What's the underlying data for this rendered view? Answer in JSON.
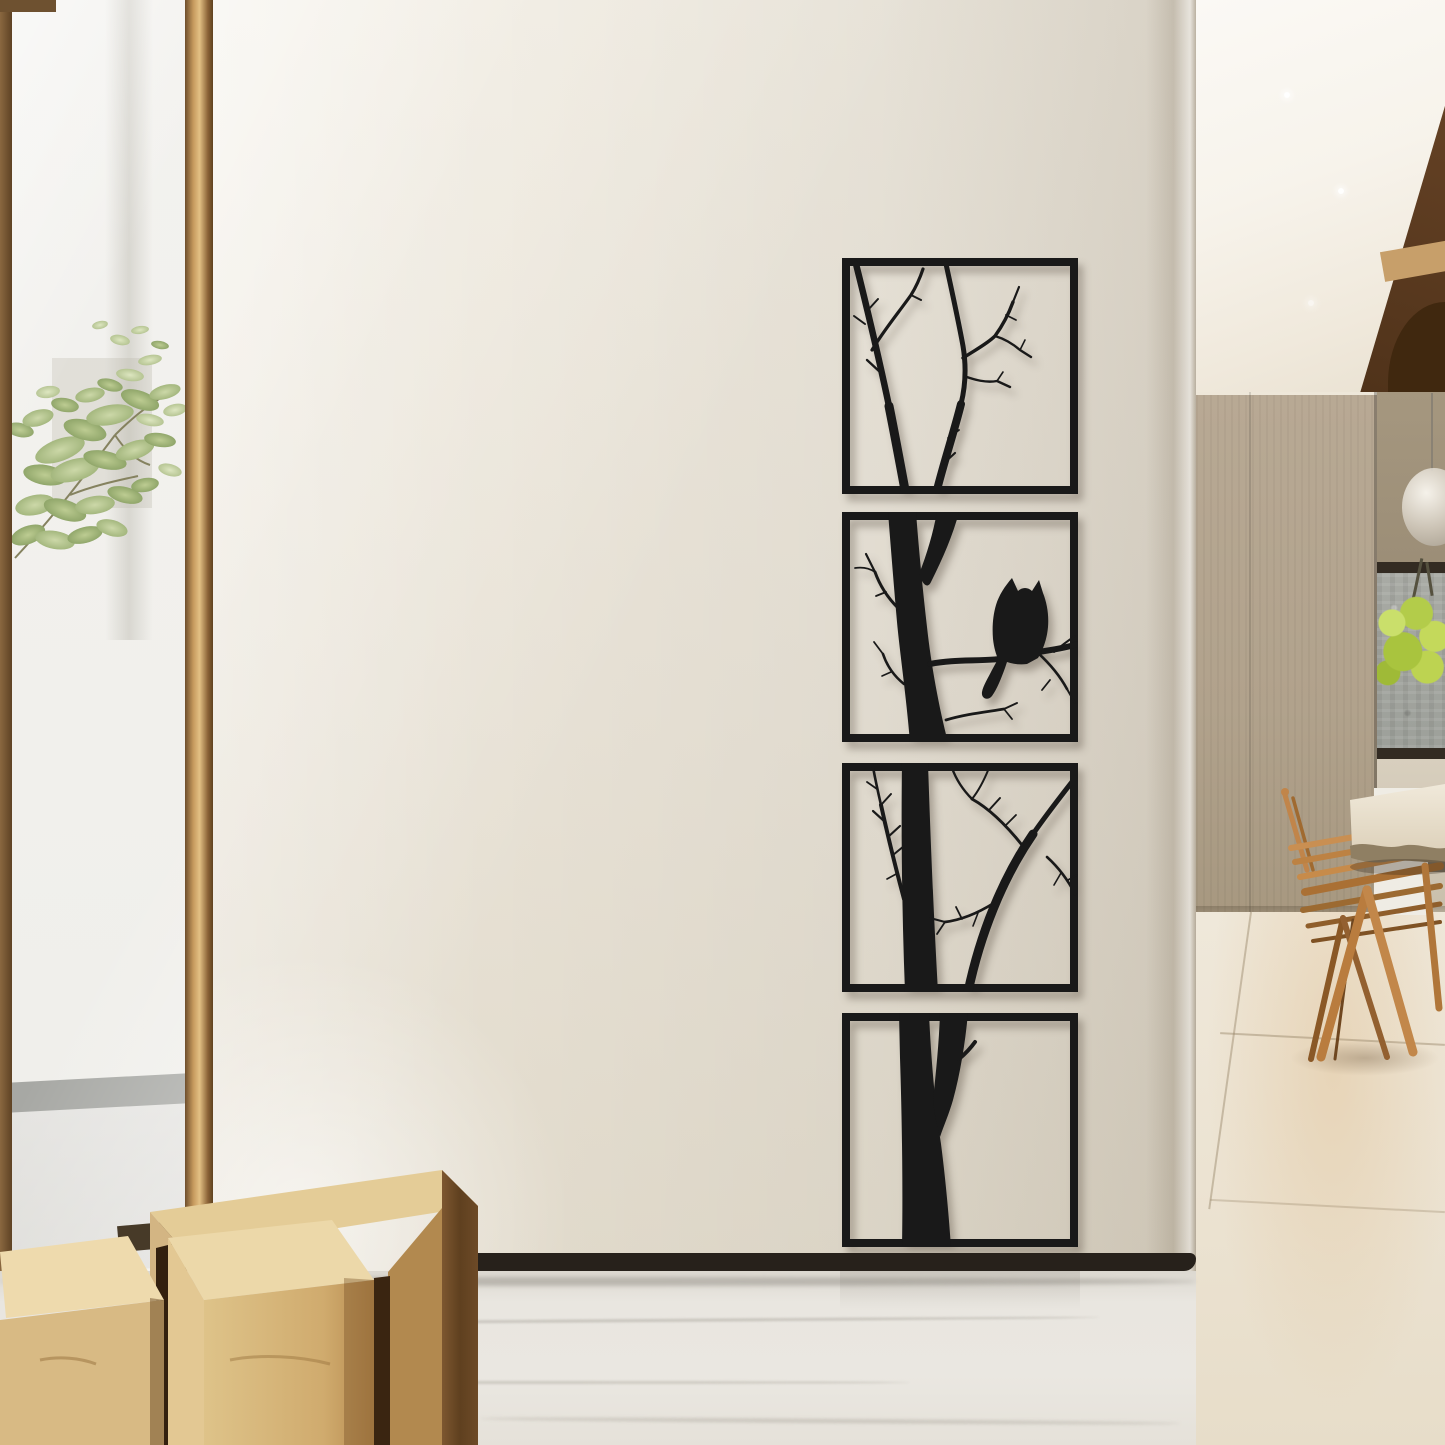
{
  "scene": {
    "setting": "modern interior with cream feature wall, floor-to-ceiling window at left and wood-panelled corridor at right",
    "focal_artwork": {
      "name": "four-panel black metal tree silhouette wall art with perched owl",
      "panel_count": 4,
      "silhouette_color": "#1a1a1a",
      "arrangement": "vertical column of square panels",
      "panels": [
        {
          "id": 1,
          "content": "upper bare branches with twigs"
        },
        {
          "id": 2,
          "content": "trunk forking, owl perched on side branch reaching the right edge"
        },
        {
          "id": 3,
          "content": "trunk with long diagonal branch and twig clusters"
        },
        {
          "id": 4,
          "content": "thick lower trunk forking near the top"
        }
      ]
    },
    "left_side": {
      "window_frame_color": "#8a6a44",
      "plant": "soft green maple-like foliage seen through glass",
      "outside_wall_color": "#f2f1ef",
      "outside_baseboard_color": "#a7a8a4"
    },
    "furniture": {
      "stools": "light maple block stools with dark walnut sides, bottom left",
      "chairs": "warm oak A-frame dining chairs, bottom right",
      "table": "light stone live-edge table slab entering from right edge"
    },
    "right_side": {
      "wood_panel_color": "#b2a38e",
      "dark_ceiling_wood_color": "#5d3c22",
      "stone_backsplash_color": "#a8aaa4",
      "flower_color": "#b5d24d",
      "pendant": "clear glass globe pendant light"
    },
    "floors": {
      "front": "white marble with gray veining",
      "corridor": "beige marble tiles with warm patch"
    },
    "palette": {
      "wall_cream": "#e8e2d6",
      "art_black": "#1a1a1a",
      "baseboard_dark": "#27211b",
      "ceiling_white": "#f8f5ef",
      "stool_wood": "#e6cf9e",
      "chair_wood": "#c08448",
      "window_post": "#c69a5e"
    }
  }
}
